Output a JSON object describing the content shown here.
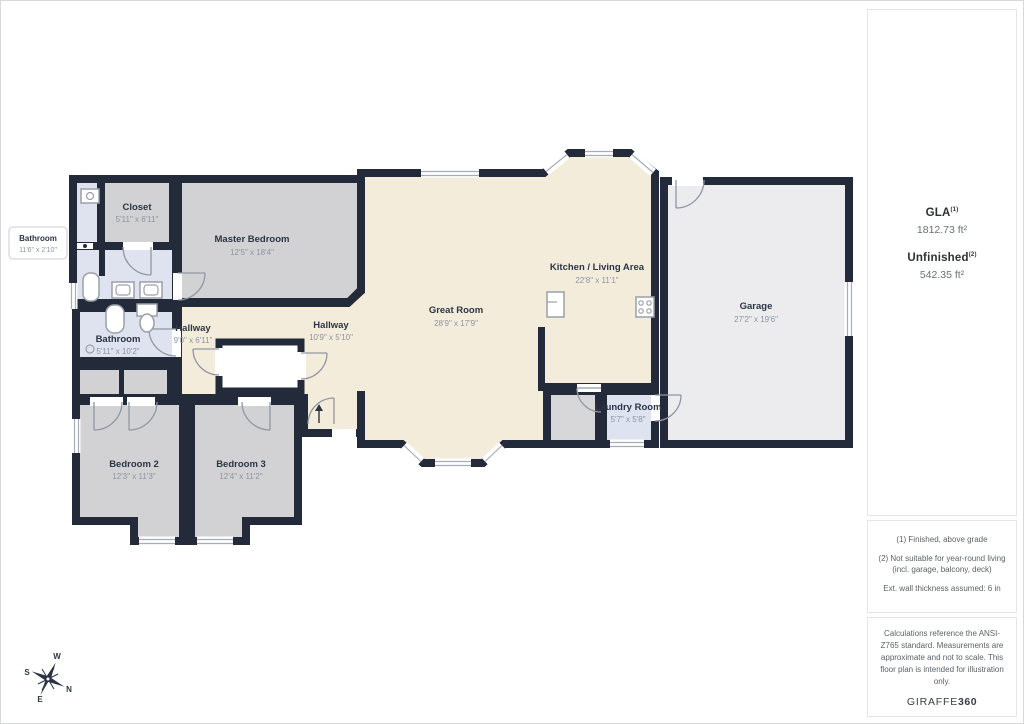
{
  "plan": {
    "rooms": [
      {
        "name": "Closet",
        "dims": "5'11\" x 6'11\""
      },
      {
        "name": "Master Bedroom",
        "dims": "12'5\" x 18'4\""
      },
      {
        "name": "Bathroom",
        "dims": "5'11\" x 10'2\""
      },
      {
        "name": "Hallway",
        "dims": "9'0\" x 6'11\""
      },
      {
        "name": "Hallway",
        "dims": "10'9\" x 5'10\""
      },
      {
        "name": "Great Room",
        "dims": "28'9\" x 17'9\""
      },
      {
        "name": "Kitchen / Living Area",
        "dims": "22'8\" x 11'1\""
      },
      {
        "name": "Garage",
        "dims": "27'2\" x 19'6\""
      },
      {
        "name": "Laundry Room",
        "dims": "5'7\" x 5'8\""
      },
      {
        "name": "Bedroom 2",
        "dims": "12'3\" x 11'3\""
      },
      {
        "name": "Bedroom 3",
        "dims": "12'4\" x 11'2\""
      }
    ],
    "external_label": {
      "name": "Bathroom",
      "dims": "11'6\" x 2'10\""
    },
    "colors": {
      "wall": "#232B3A",
      "floor_living": "#F3ECDA",
      "floor_bedroom": "#D2D2D4",
      "floor_bath": "#DEE3EF",
      "floor_garage": "#ECECEE"
    }
  },
  "sidebar": {
    "gla": {
      "label": "GLA",
      "sup": "(1)",
      "value": "1812.73 ft²"
    },
    "unfinished": {
      "label": "Unfinished",
      "sup": "(2)",
      "value": "542.35 ft²"
    },
    "notes": [
      "(1) Finished, above grade",
      "(2) Not suitable for year-round living (incl. garage, balcony, deck)",
      "Ext. wall thickness assumed: 6 in"
    ],
    "disclaimer": "Calculations reference the ANSI-Z765 standard. Measurements are approximate and not to scale. This floor plan is intended for illustration only.",
    "brand": {
      "name": "GIRAFFE",
      "suffix": "360"
    }
  },
  "compass": {
    "n": "N",
    "e": "E",
    "s": "S",
    "w": "W"
  }
}
